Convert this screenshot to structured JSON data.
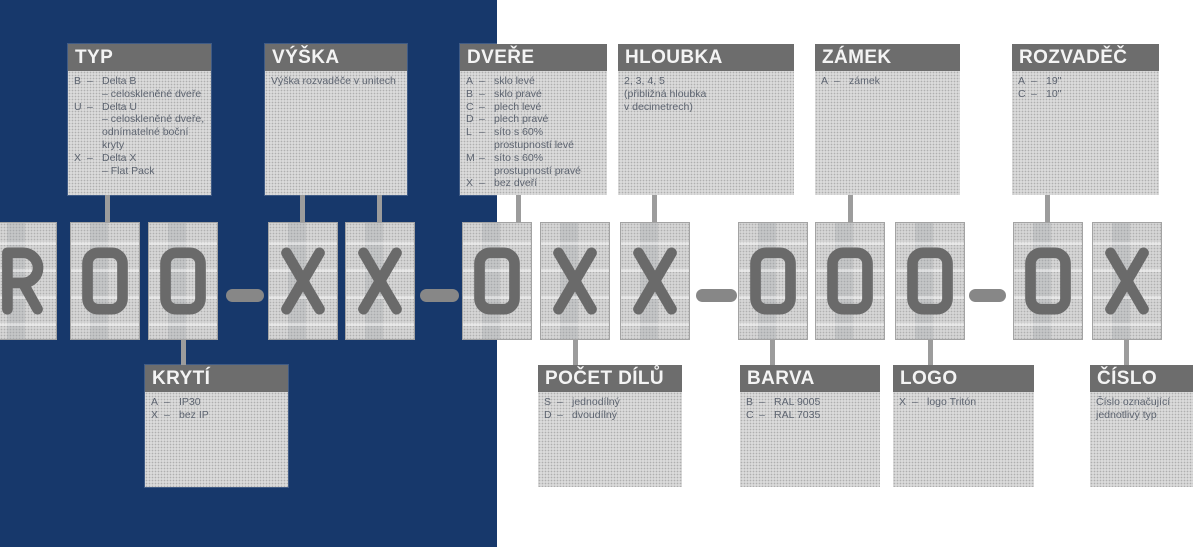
{
  "colors": {
    "background_left": "#17386B",
    "background_right": "#FFFFFF",
    "label_header_bg": "#6D6D6D",
    "label_header_text": "#F4F4F4",
    "label_body_bg": "#DADADA",
    "label_body_text": "#5D6470",
    "code_box_bg": "#D5D5D5",
    "code_glyph": "#6A6A6A",
    "connector": "#9C9C9C",
    "dash": "#878787"
  },
  "code": {
    "string": "R00-XX-0XX-000-0X",
    "chars": [
      "R",
      "0",
      "0",
      "X",
      "X",
      "0",
      "X",
      "X",
      "0",
      "0",
      "0",
      "0",
      "X"
    ],
    "separator": "–"
  },
  "labels": {
    "typ": {
      "title": "TYP",
      "lines": [
        {
          "k": "B",
          "t": "Delta B"
        },
        {
          "k": "",
          "t": "– celoskleněné dveře"
        },
        {
          "k": "U",
          "t": "Delta U"
        },
        {
          "k": "",
          "t": "– celoskleněné dveře,"
        },
        {
          "k": "",
          "t": "odnímatelné boční"
        },
        {
          "k": "",
          "t": "kryty"
        },
        {
          "k": "X",
          "t": "Delta X"
        },
        {
          "k": "",
          "t": "– Flat Pack"
        }
      ]
    },
    "vyska": {
      "title": "VÝŠKA",
      "lines": [
        "Výška rozvaděče v unitech"
      ]
    },
    "dvere": {
      "title": "DVEŘE",
      "lines": [
        {
          "k": "A",
          "t": "sklo levé"
        },
        {
          "k": "B",
          "t": "sklo pravé"
        },
        {
          "k": "C",
          "t": "plech levé"
        },
        {
          "k": "D",
          "t": "plech pravé"
        },
        {
          "k": "L",
          "t": "síto s 60%"
        },
        {
          "k": "",
          "t": "prostupností levé"
        },
        {
          "k": "M",
          "t": "síto s 60%"
        },
        {
          "k": "",
          "t": "prostupností pravé"
        },
        {
          "k": "X",
          "t": "bez dveří"
        }
      ]
    },
    "hloubka": {
      "title": "HLOUBKA",
      "lines": [
        "2, 3, 4, 5",
        "(přibližná hloubka",
        "v decimetrech)"
      ]
    },
    "zamek": {
      "title": "ZÁMEK",
      "lines": [
        {
          "k": "A",
          "t": "zámek"
        }
      ]
    },
    "rozvadec": {
      "title": "ROZVADĚČ",
      "lines": [
        {
          "k": "A",
          "t": "19\""
        },
        {
          "k": "C",
          "t": "10\""
        }
      ]
    },
    "kryti": {
      "title": "KRYTÍ",
      "lines": [
        {
          "k": "A",
          "t": "IP30"
        },
        {
          "k": "X",
          "t": "bez IP"
        }
      ]
    },
    "pocet_dilu": {
      "title": "POČET DÍLŮ",
      "lines": [
        {
          "k": "S",
          "t": "jednodílný"
        },
        {
          "k": "D",
          "t": "dvoudílný"
        }
      ]
    },
    "barva": {
      "title": "BARVA",
      "lines": [
        {
          "k": "B",
          "t": "RAL 9005"
        },
        {
          "k": "C",
          "t": "RAL 7035"
        }
      ]
    },
    "logo": {
      "title": "LOGO",
      "lines": [
        {
          "k": "X",
          "t": "logo Tritón"
        }
      ]
    },
    "cislo": {
      "title": "ČÍSLO",
      "lines": [
        "Číslo označující",
        "jednotlivý typ"
      ]
    }
  }
}
